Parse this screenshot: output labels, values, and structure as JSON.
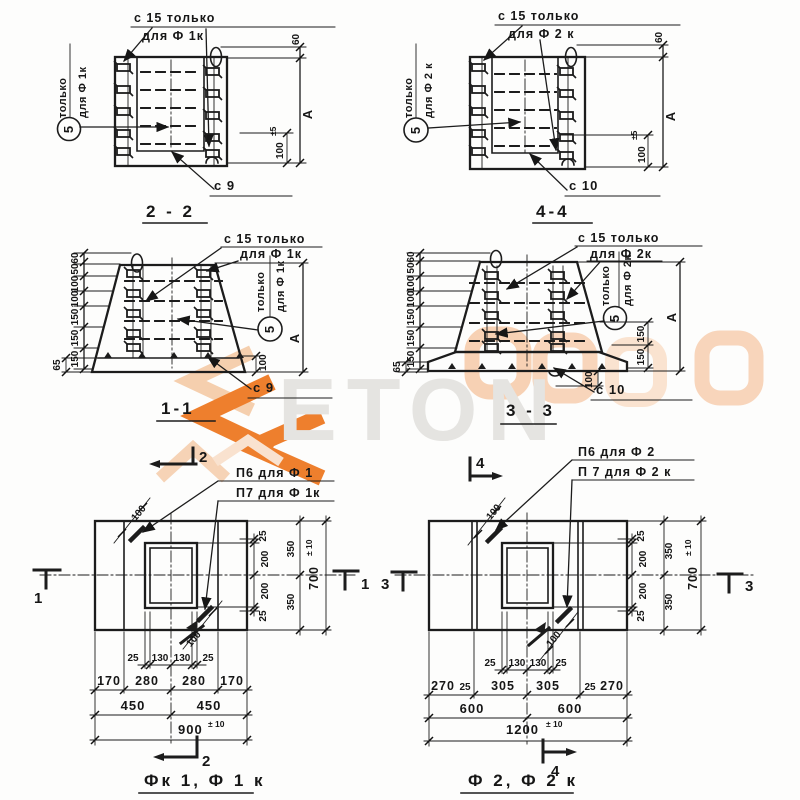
{
  "watermark": {
    "text": "ETON"
  },
  "s22": {
    "title": "2 - 2",
    "lbl_top1": "с 15 только",
    "lbl_top2": "для Ф 1к",
    "side1": "только",
    "side2": "для Ф 1к",
    "callout": "5",
    "lbl_bottom": "с 9",
    "d60": "60",
    "dA": "А",
    "d100": "100",
    "tol": "±5"
  },
  "s44": {
    "title": "4-4",
    "lbl_top1": "с 15 только",
    "lbl_top2": "для Ф 2 к",
    "side1": "только",
    "side2": "для Ф 2 к",
    "callout": "5",
    "lbl_bottom": "с 10",
    "d60": "60",
    "dA": "А",
    "d100": "100",
    "tol": "±5"
  },
  "s11": {
    "title": "1-1",
    "lbl_top1": "с 15 только",
    "lbl_top2": "для Ф 1к",
    "side1": "только",
    "side2": "для Ф 1к",
    "callout": "5",
    "lbl_bottom": "с 9",
    "dims": [
      "60",
      "50",
      "100",
      "100",
      "150",
      "150",
      "150"
    ],
    "d65": "65",
    "d100": "100",
    "dA": "А"
  },
  "s33": {
    "title": "3 - 3",
    "lbl_top1": "с 15 только",
    "lbl_top2": "для Ф 2к",
    "side1": "только",
    "side2": "для Ф 2к",
    "callout": "5",
    "lbl_bottom": "с 10",
    "dims": [
      "60",
      "50",
      "100",
      "100",
      "150",
      "150",
      "150"
    ],
    "d65": "65",
    "d100": "100",
    "dA": "А",
    "r150a": "150",
    "r150b": "150"
  },
  "p1": {
    "title": "Фк 1,  Ф 1 к",
    "p6": "П6 для Ф 1",
    "p7": "П7 для Ф 1к",
    "mk_top": "2",
    "mk_bottom": "2",
    "mk_left": "1",
    "mk_right": "1",
    "diag_top": "100",
    "diag_bot": "100",
    "r": [
      "25",
      "350",
      "200",
      "200",
      "350",
      "25"
    ],
    "rtot": "700",
    "rtol": "± 10",
    "row1": [
      "25",
      "130",
      "130",
      "25"
    ],
    "row2": [
      "170",
      "280",
      "280",
      "170"
    ],
    "row3": [
      "450",
      "450"
    ],
    "tot": "900",
    "tol": "± 10"
  },
  "p2": {
    "title": "Ф 2,   Ф 2 к",
    "p6": "П6 для Ф 2",
    "p7": "П 7 для Ф 2 к",
    "mk_top": "4",
    "mk_bottom": "4",
    "mk_left": "3",
    "mk_right": "3",
    "diag_top": "100",
    "diag_bot": "100",
    "r": [
      "25",
      "350",
      "200",
      "200",
      "350",
      "25"
    ],
    "rtot": "700",
    "rtol": "± 10",
    "row1": [
      "25",
      "130",
      "130",
      "25"
    ],
    "row2": [
      "270",
      "25",
      "305",
      "305",
      "25",
      "270"
    ],
    "row3": [
      "600",
      "600"
    ],
    "tot": "1200",
    "tol": "± 10"
  }
}
